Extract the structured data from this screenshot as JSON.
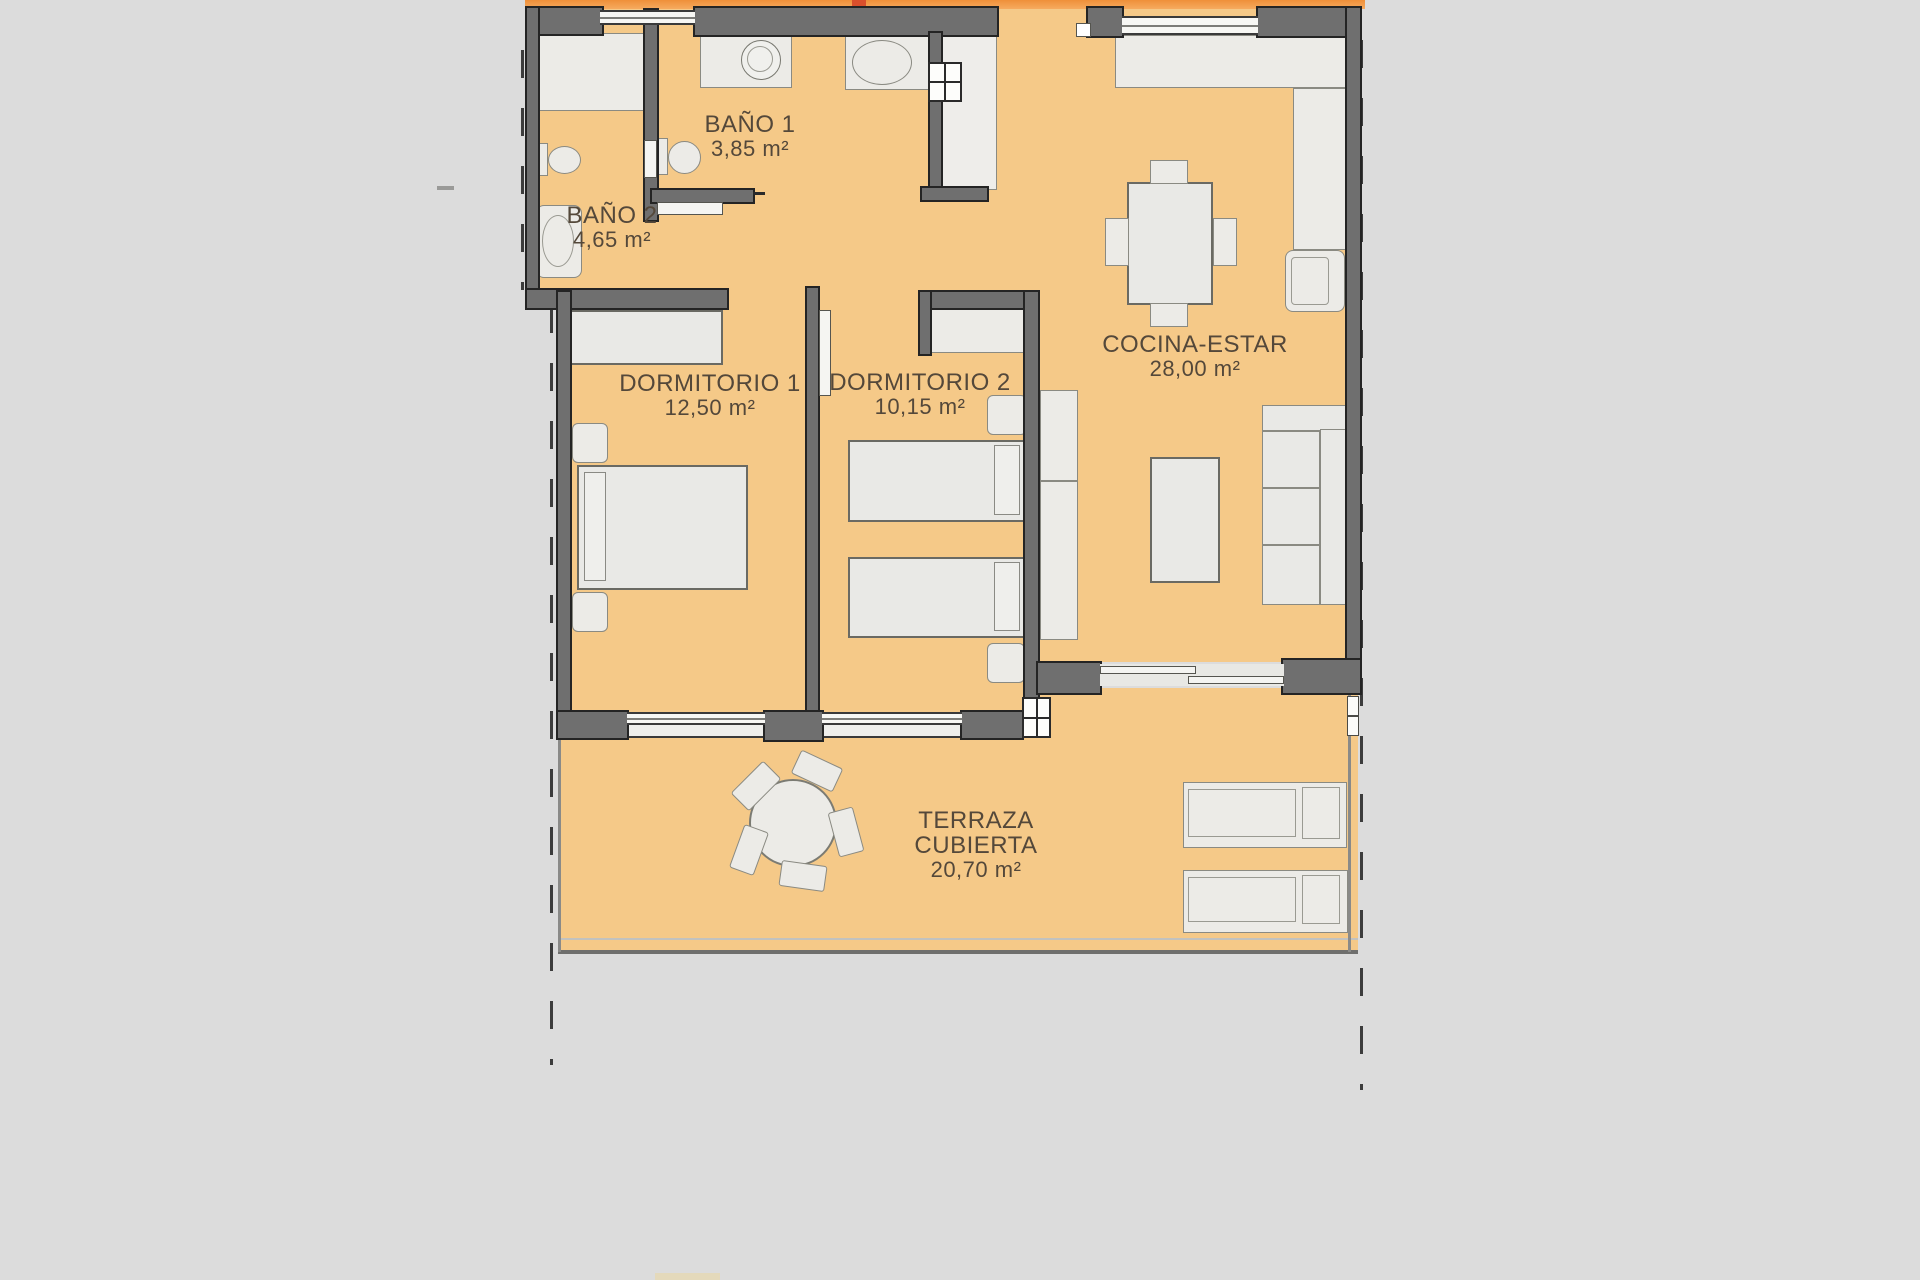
{
  "plan_type": "apartment-floor-plan",
  "rooms": [
    {
      "key": "bano1",
      "label": "BAÑO 1",
      "area": "3,85 m²"
    },
    {
      "key": "bano2",
      "label": "BAÑO 2",
      "area": "4,65 m²"
    },
    {
      "key": "dormitorio1",
      "label": "DORMITORIO 1",
      "area": "12,50 m²"
    },
    {
      "key": "dormitorio2",
      "label": "DORMITORIO 2",
      "area": "10,15 m²"
    },
    {
      "key": "cocina",
      "label": "COCINA-ESTAR",
      "area": "28,00 m²"
    },
    {
      "key": "terraza",
      "label": "TERRAZA CUBIERTA",
      "area": "20,70 m²"
    }
  ],
  "colors": {
    "background": "#dcdcdc",
    "floor": "#f5c988",
    "wall": "#6f6f6f",
    "accent_strip": "#f4a04c",
    "accent_red": "#d94f2c",
    "text": "#54483a"
  }
}
